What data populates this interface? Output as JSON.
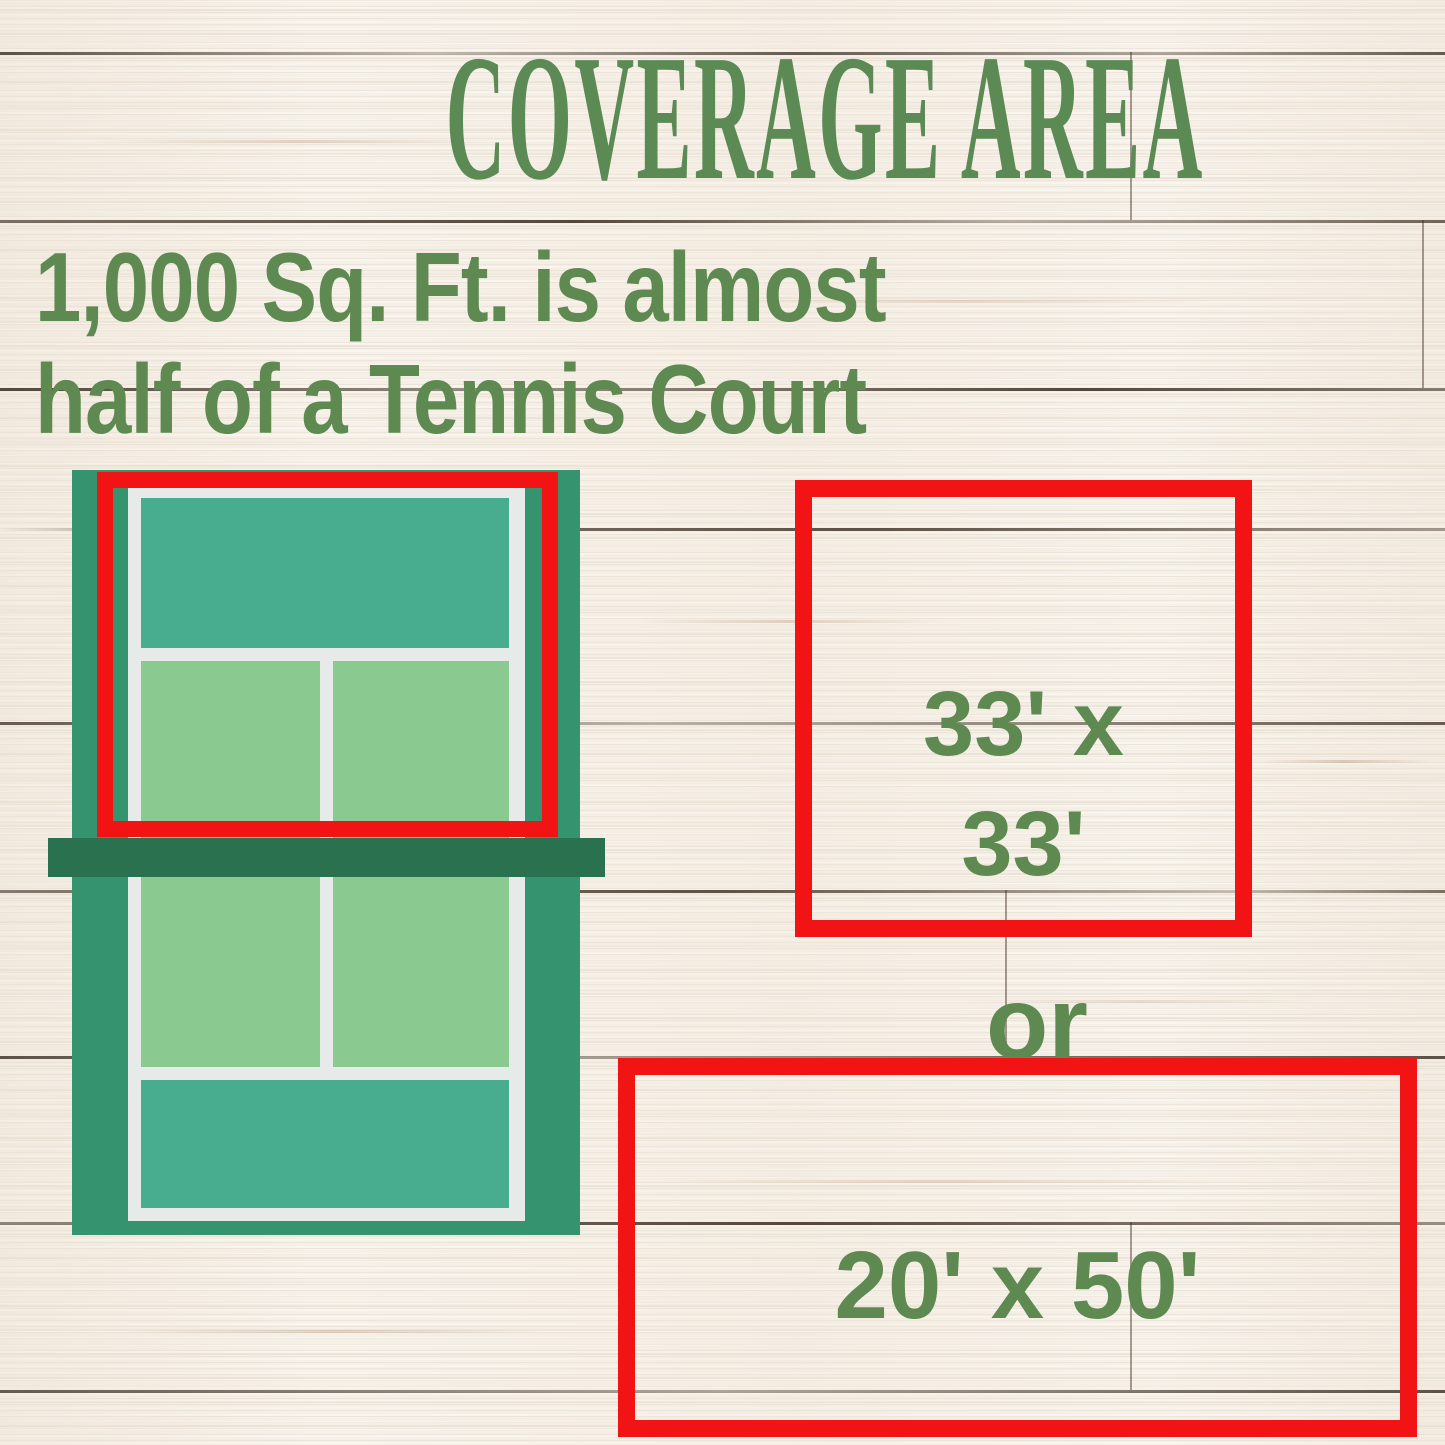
{
  "title": "COVERAGE AREA",
  "subtitle": {
    "line1": "1,000 Sq. Ft. is almost",
    "line2": "half of a Tennis Court"
  },
  "comparison": {
    "square": {
      "line1": "33' x",
      "line2": "33'"
    },
    "separator": "or",
    "rectangle": {
      "label": "20' x 50'"
    }
  },
  "colors": {
    "red": "#F21414",
    "title-green": "#5C8A55",
    "text-green": "#5E8A52",
    "court-frame": "#35936F",
    "court-teal": "#47AD8E",
    "court-light": "#8ACA90",
    "court-net": "#29714F",
    "court-line": "#E6EAE9",
    "wood-base": "#F5F0E8"
  }
}
